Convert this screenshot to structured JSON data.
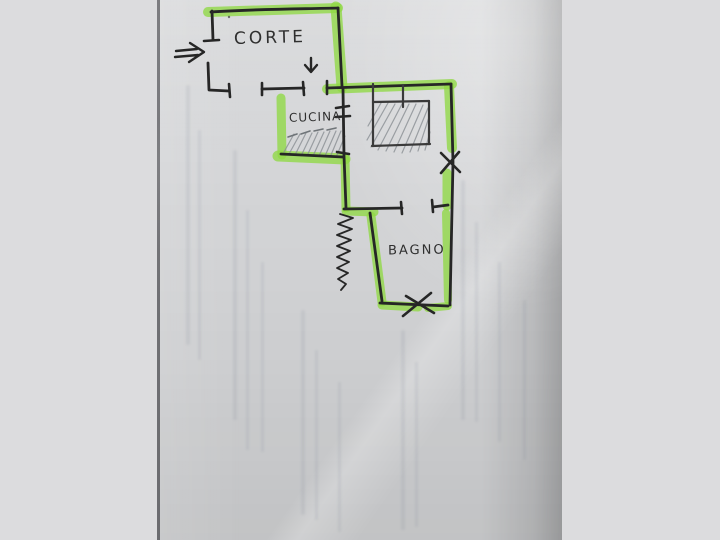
{
  "floorplan": {
    "rooms": [
      {
        "id": "corte",
        "label": "CORTE"
      },
      {
        "id": "cucina",
        "label": "CUCINA"
      },
      {
        "id": "bagno",
        "label": "BAGNO"
      }
    ],
    "symbols": [
      "entrance-double-arrow-icon",
      "down-arrow-icon",
      "x-mark-right-wall",
      "x-mark-bagno-bottom-wall",
      "coil-squiggle",
      "window-tick-marks",
      "hatched-fixture-block",
      "hatched-strip-cucina",
      "dashed-pencil-line"
    ],
    "colors": {
      "highlighter": "#8fd944",
      "ink": "#262626",
      "pencil": "#8a8f93",
      "paper": "#d5d6d8",
      "margin": "#dcdcde"
    }
  }
}
